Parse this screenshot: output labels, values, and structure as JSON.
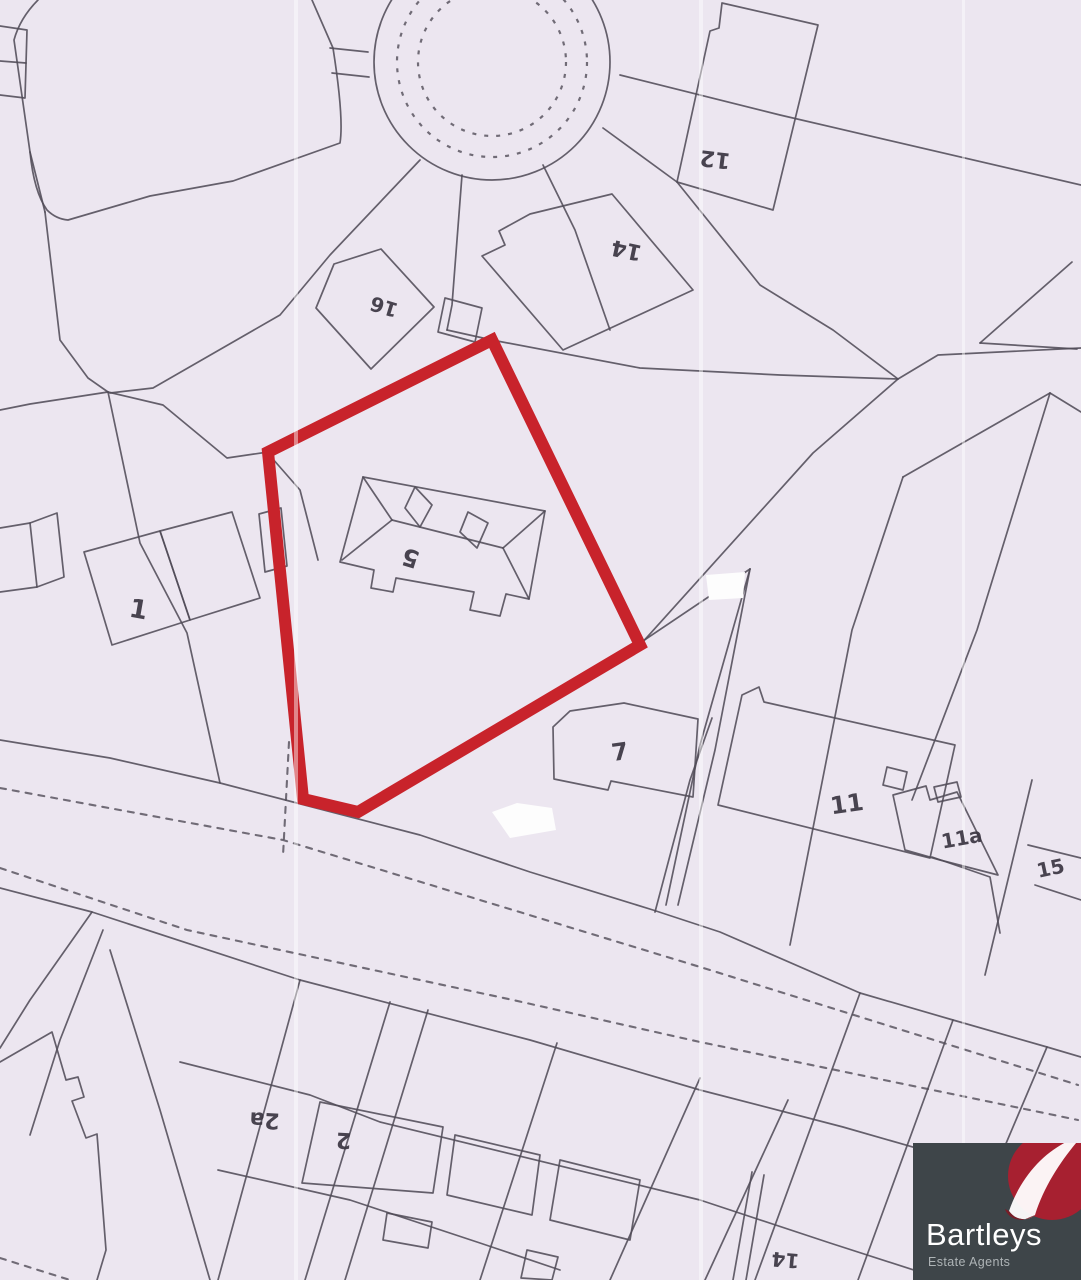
{
  "map": {
    "type": "site-plan",
    "background_color": "#ece6f0",
    "line_color": "#514c58",
    "highlight_color": "#c8232b",
    "highlighted_plot_house_number": "5",
    "plot_labels": [
      {
        "text": "1",
        "x": 137,
        "y": 618,
        "rot": 10,
        "size": 26
      },
      {
        "text": "5",
        "x": 413,
        "y": 550,
        "rot": 197,
        "size": 24
      },
      {
        "text": "7",
        "x": 621,
        "y": 760,
        "rot": -8,
        "size": 24
      },
      {
        "text": "11",
        "x": 848,
        "y": 812,
        "rot": -8,
        "size": 24
      },
      {
        "text": "11a",
        "x": 963,
        "y": 845,
        "rot": -10,
        "size": 20
      },
      {
        "text": "15",
        "x": 1052,
        "y": 875,
        "rot": -12,
        "size": 20
      },
      {
        "text": "12",
        "x": 716,
        "y": 152,
        "rot": 187,
        "size": 22
      },
      {
        "text": "14",
        "x": 628,
        "y": 243,
        "rot": 192,
        "size": 22
      },
      {
        "text": "16",
        "x": 386,
        "y": 300,
        "rot": 197,
        "size": 20
      },
      {
        "text": "2a",
        "x": 265,
        "y": 1113,
        "rot": 183,
        "size": 22
      },
      {
        "text": "2",
        "x": 344,
        "y": 1133,
        "rot": 183,
        "size": 22
      },
      {
        "text": "14",
        "x": 786,
        "y": 1253,
        "rot": 185,
        "size": 20
      }
    ]
  },
  "logo": {
    "brand": "Bartleys",
    "tagline": "Estate Agents",
    "background_color": "#3e4549",
    "accent_color": "#a72030",
    "text_color": "#ffffff"
  }
}
